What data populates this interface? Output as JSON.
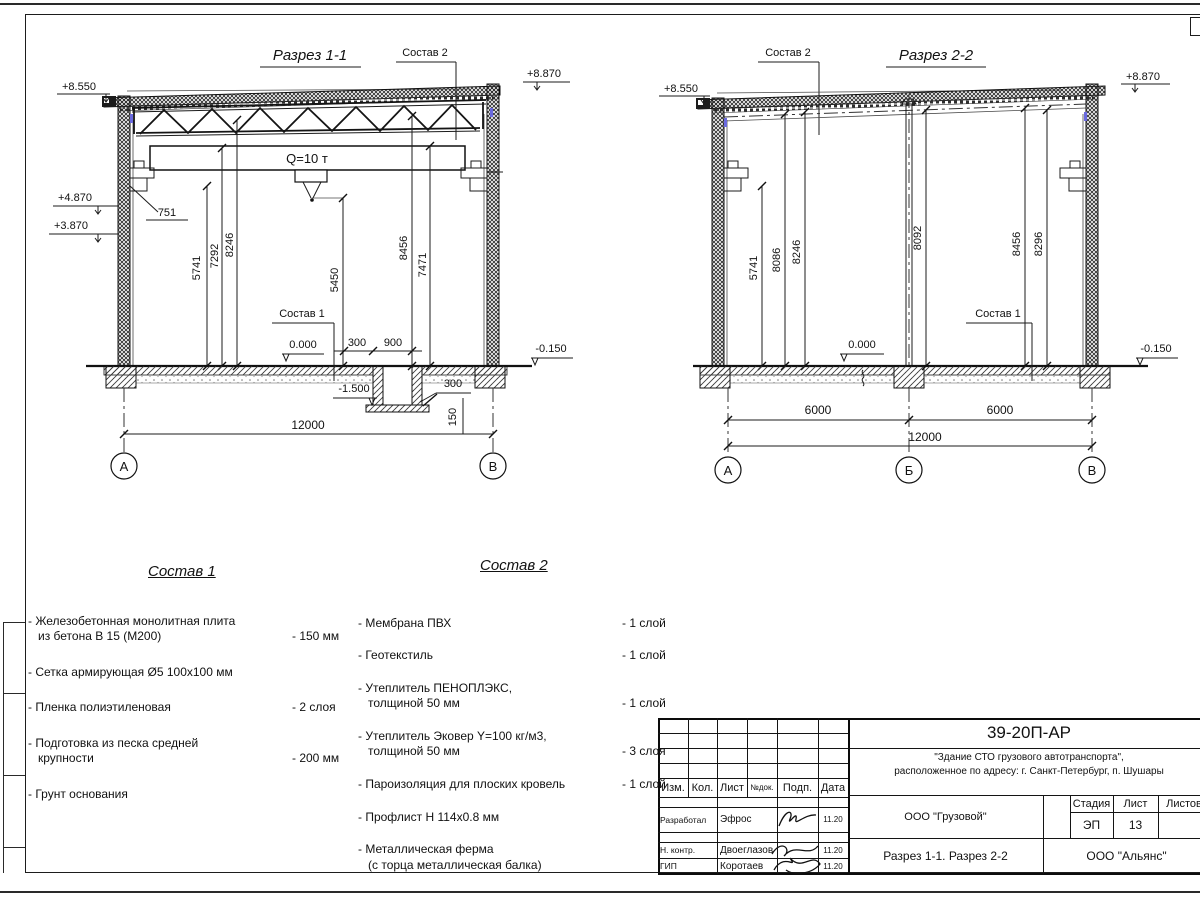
{
  "section1": {
    "title": "Разрез 1-1",
    "sostav2_label": "Состав 2",
    "sostav1_label": "Состав 1",
    "crane_label": "Q=10 т",
    "elev_top_left": "+8.550",
    "elev_top_right": "+8.870",
    "elev_crane": "+4.870",
    "elev_corbel": "+3.870",
    "elev_floor": "0.000",
    "elev_ground": "-0.150",
    "elev_pit": "-1.500",
    "dim_751": "751",
    "dims_vertical": [
      "5741",
      "7292",
      "8246",
      "5450",
      "8456",
      "7471"
    ],
    "dim_pit_offset": "300",
    "dim_pit_width": "900",
    "dim_pit_wall": "300",
    "dim_pit_slab": "150",
    "dim_span": "12000",
    "axis_a": "А",
    "axis_b": "В"
  },
  "section2": {
    "title": "Разрез 2-2",
    "sostav2_label": "Состав 2",
    "sostav1_label": "Состав 1",
    "elev_top_left": "+8.550",
    "elev_top_right": "+8.870",
    "elev_floor": "0.000",
    "elev_ground": "-0.150",
    "dims_vertical": [
      "5741",
      "8086",
      "8246",
      "8092",
      "8456",
      "8296"
    ],
    "dim_bay1": "6000",
    "dim_bay2": "6000",
    "dim_span": "12000",
    "axis_a": "А",
    "axis_b": "Б",
    "axis_c": "В"
  },
  "sostav1": {
    "title": "Состав 1",
    "items": [
      {
        "name": "- Железобетонная монолитная плита\nиз бетона В 15 (М200)",
        "value": "- 150 мм"
      },
      {
        "name": "- Сетка армирующая Ø5 100х100 мм",
        "value": ""
      },
      {
        "name": "- Пленка полиэтиленовая",
        "value": "-  2 слоя"
      },
      {
        "name": "- Подготовка из песка средней\nкрупности",
        "value": "- 200 мм"
      },
      {
        "name": "- Грунт основания",
        "value": ""
      }
    ]
  },
  "sostav2": {
    "title": "Состав 2",
    "items": [
      {
        "name": "- Мембрана ПВХ",
        "value": "- 1 слой"
      },
      {
        "name": "- Геотекстиль",
        "value": "- 1 слой"
      },
      {
        "name": "- Утеплитель ПЕНОПЛЭКС,\nтолщиной 50 мм",
        "value": "- 1 слой"
      },
      {
        "name": "- Утеплитель Эковер Y=100 кг/м3,\nтолщиной 50 мм",
        "value": "- 3 слоя"
      },
      {
        "name": "- Пароизоляция для плоских кровель",
        "value": "- 1 слой"
      },
      {
        "name": "- Профлист Н 114х0.8 мм",
        "value": ""
      },
      {
        "name": "- Металлическая ферма\n(с торца металлическая балка)",
        "value": ""
      }
    ]
  },
  "titleblock": {
    "doc_number": "39-20П-АР",
    "project_line1": "\"Здание СТО грузового автотранспорта\",",
    "project_line2": "расположенное по адресу: г. Санкт-Петербург, п. Шушары",
    "col_izm": "Изм.",
    "col_kol": "Кол.",
    "col_list": "Лист",
    "col_ndok": "№док.",
    "col_podp": "Подп.",
    "col_data": "Дата",
    "rows": [
      {
        "role": "Разработал",
        "name": "Эфрос",
        "date": "11.20"
      },
      {
        "role": "Н. контр.",
        "name": "Двоеглазов",
        "date": "11.20"
      },
      {
        "role": "ГИП",
        "name": "Коротаев",
        "date": "11.20"
      }
    ],
    "org_customer": "ООО \"Грузовой\"",
    "stage_label": "Стадия",
    "sheet_label": "Лист",
    "sheets_label": "Листов",
    "stage": "ЭП",
    "sheet_no": "13",
    "sheet_title": "Разрез 1-1. Разрез 2-2",
    "org": "ООО \"Альянс\""
  }
}
